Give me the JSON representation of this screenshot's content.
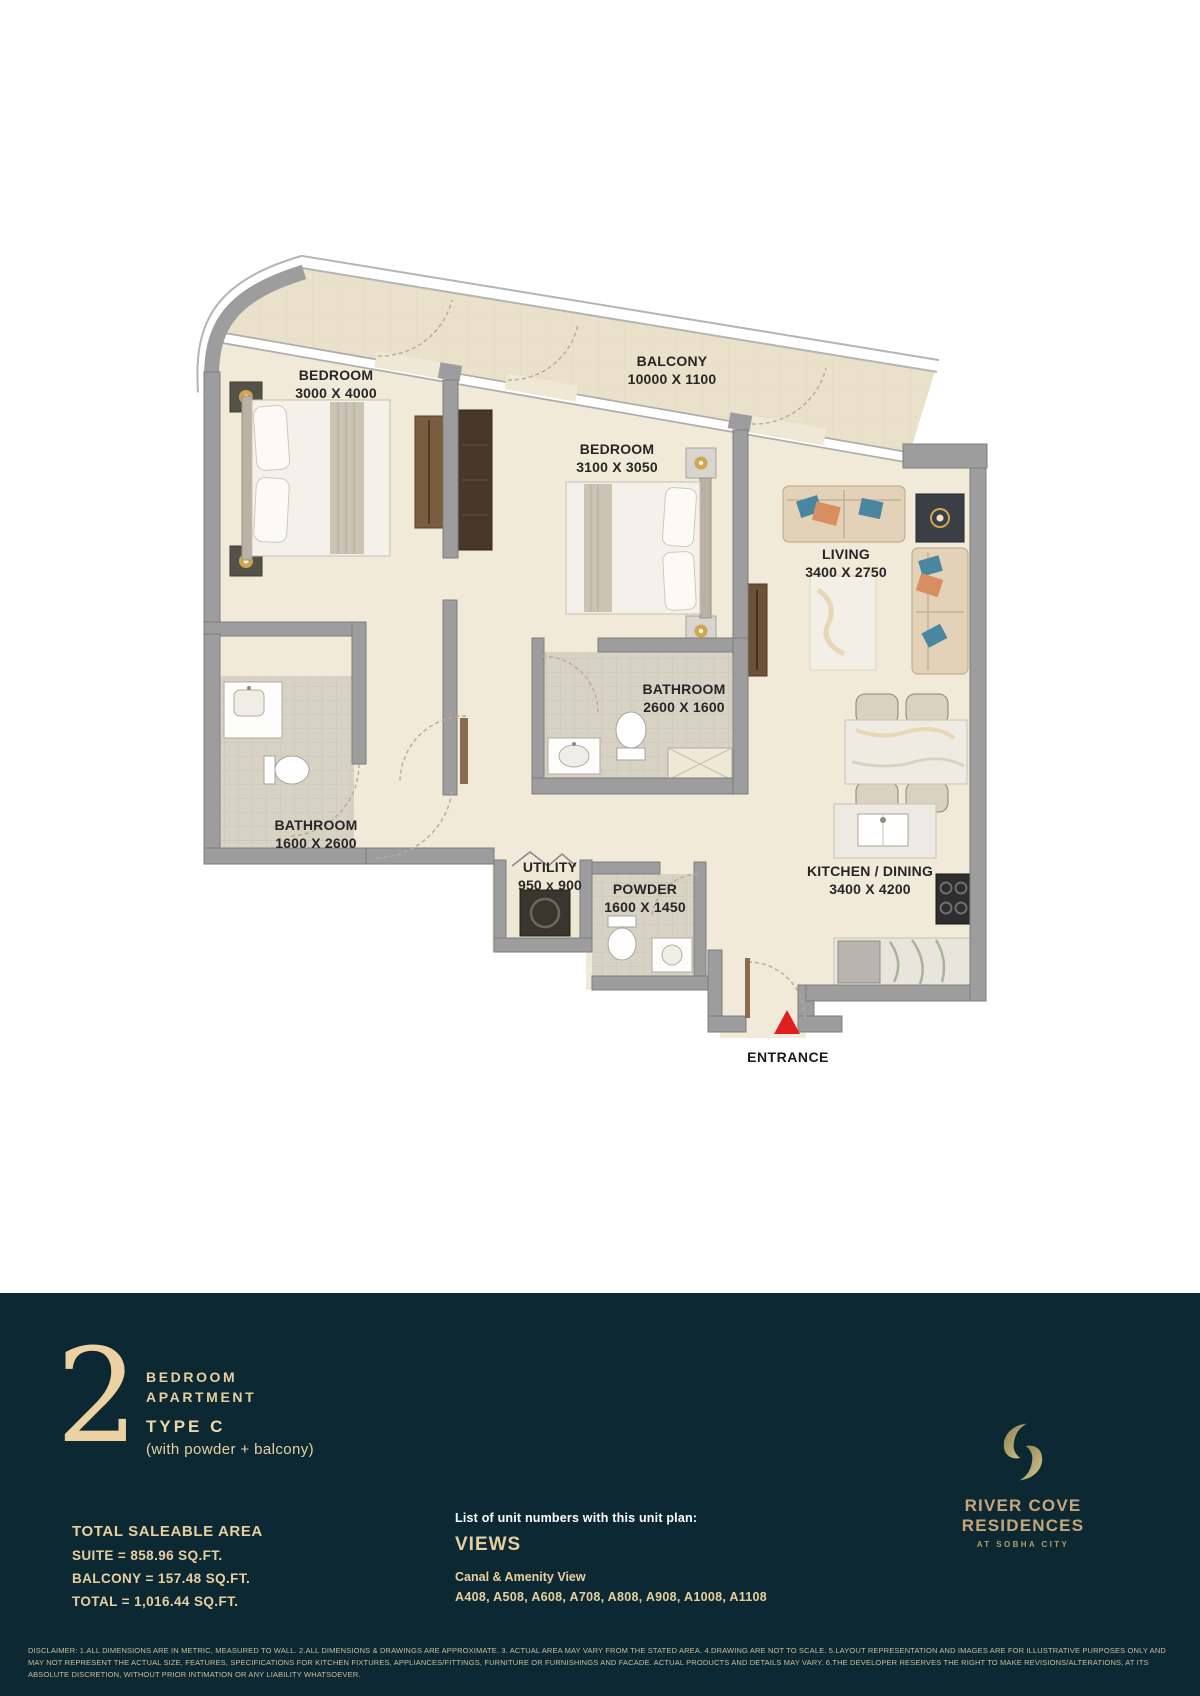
{
  "plan": {
    "rooms": [
      {
        "name": "BEDROOM",
        "dims": "3000 X 4000"
      },
      {
        "name": "BALCONY",
        "dims": "10000 X 1100"
      },
      {
        "name": "BEDROOM",
        "dims": "3100 X 3050"
      },
      {
        "name": "LIVING",
        "dims": "3400 X 2750"
      },
      {
        "name": "BATHROOM",
        "dims": "2600 X 1600"
      },
      {
        "name": "BATHROOM",
        "dims": "1600 X 2600"
      },
      {
        "name": "UTILITY",
        "dims": "950 x 900"
      },
      {
        "name": "POWDER",
        "dims": "1600 X 1450"
      },
      {
        "name": "KITCHEN / DINING",
        "dims": "3400 X 4200"
      }
    ],
    "entrance_label": "ENTRANCE"
  },
  "footer": {
    "unit_number": "2",
    "unit_type_line1": "BEDROOM",
    "unit_type_line2": "APARTMENT",
    "type_label": "TYPE C",
    "type_sub": "(with powder + balcony)",
    "area": {
      "title": "TOTAL SALEABLE AREA",
      "suite": "SUITE = 858.96 SQ.FT.",
      "balcony": "BALCONY = 157.48 SQ.FT.",
      "total": "TOTAL = 1,016.44 SQ.FT."
    },
    "units": {
      "intro": "List of unit numbers with this unit plan:",
      "views_title": "VIEWS",
      "view_type": "Canal & Amenity View",
      "unit_list": "A408, A508, A608, A708, A808, A908, A1008, A1108"
    },
    "brand": {
      "name": "RIVER COVE RESIDENCES",
      "sub": "AT SOBHA CITY"
    },
    "disclaimer": "DISCLAIMER: 1.ALL DIMENSIONS ARE IN METRIC, MEASURED TO WALL. 2.ALL DIMENSIONS & DRAWINGS ARE APPROXIMATE. 3. ACTUAL AREA MAY VARY FROM THE STATED AREA. 4.DRAWING ARE NOT TO SCALE. 5.LAYOUT REPRESENTATION AND IMAGES ARE FOR ILLUSTRATIVE PURPOSES ONLY AND MAY NOT REPRESENT THE ACTUAL SIZE, FEATURES, SPECIFICATIONS FOR KITCHEN FIXTURES, APPLIANCES/FITTINGS, FURNITURE OR FURNISHINGS AND FACADE. ACTUAL PRODUCTS AND DETAILS MAY VARY. 6.THE DEVELOPER RESERVES THE RIGHT TO MAKE REVISIONS/ALTERATIONS, AT ITS ABSOLUTE DISCRETION, WITHOUT PRIOR INTIMATION OR ANY LIABILITY WHATSOEVER."
  },
  "colors": {
    "footer_bg": "#0c2933",
    "cream_text": "#e8cfa0",
    "brand_gold": "#c6a678",
    "entrance_arrow": "#e02020",
    "wall_gray": "#9d9d9d",
    "floor_cream": "#f1ead8",
    "balcony_floor": "#e9e1c9",
    "tile_gray": "#d8d2c5",
    "wood_brown": "#6a5138",
    "sofa_beige": "#e3d2b8",
    "cushion_blue": "#4a86a0",
    "cushion_orange": "#d98e62",
    "lamp_gold": "#d2a64e"
  }
}
